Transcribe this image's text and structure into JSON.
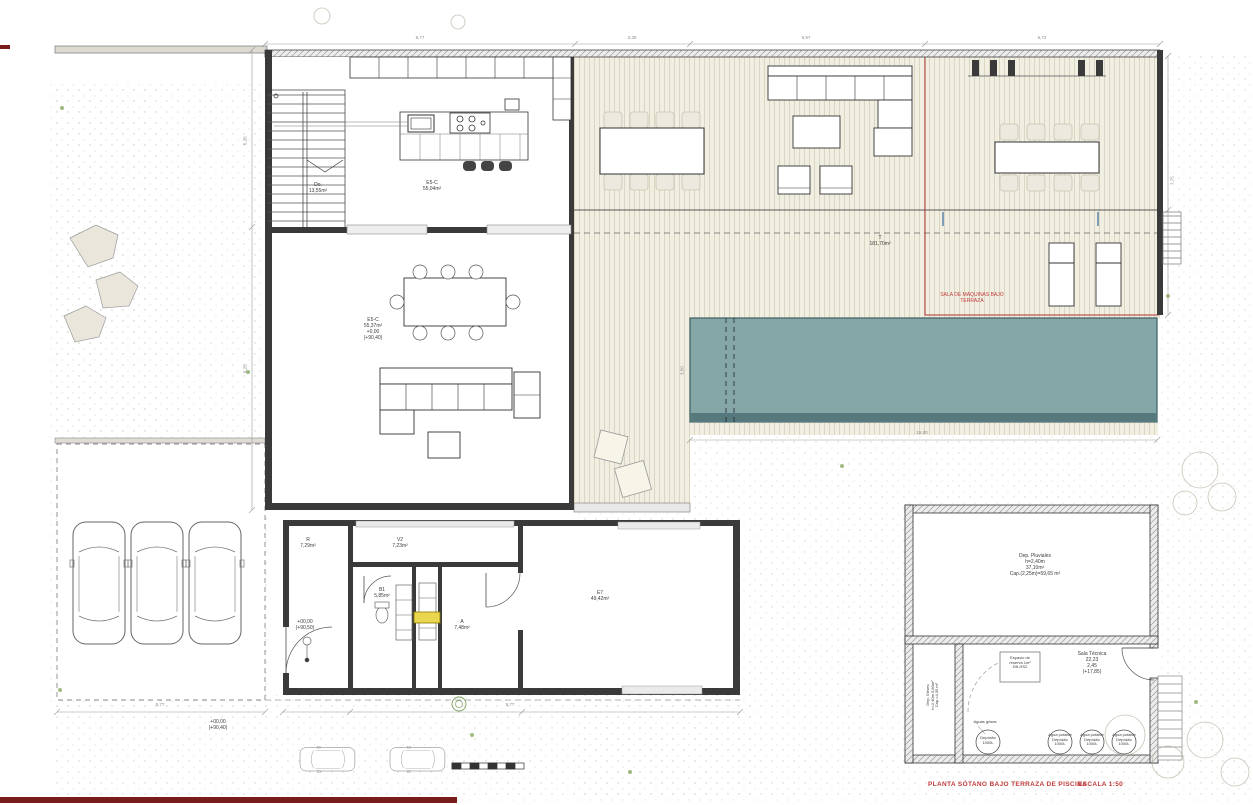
{
  "drawing": {
    "title": "PLANTA SÓTANO BAJO TERRAZA DE PISCINA",
    "scale": "ESCALA 1:50"
  },
  "colors": {
    "pool": "#85a7a8",
    "pool_dark": "#55797c",
    "deck": "#f1eee2",
    "deck_line": "#dbd6c2",
    "wall": "#3a3a3a",
    "red_line": "#b03232",
    "dark_red": "#7a1c1c",
    "annotation_red": "#c23b3b",
    "dim_grey": "#8a8a8a",
    "terrain_dot": "#b9b0a0",
    "boiler_yellow": "#ead64f",
    "green": "#8fae6b"
  },
  "annotations": [
    {
      "name": "stair-room-label",
      "text": "Do.\n13,55m²",
      "x": 318,
      "y": 183,
      "size": 5
    },
    {
      "name": "kitchen-label",
      "text": "E5-C\n55,04m²",
      "x": 432,
      "y": 181,
      "size": 5
    },
    {
      "name": "living-label",
      "text": "E5-C\n55,37m²\n+0,00\n(+90,40)",
      "x": 373,
      "y": 318,
      "size": 5
    },
    {
      "name": "terrace-label",
      "text": "T\n181,70m²",
      "x": 880,
      "y": 236,
      "size": 5
    },
    {
      "name": "machine-room-label",
      "text": "SALA DE MAQUINAS BAJO\nTERRAZA",
      "x": 972,
      "y": 293,
      "size": 5,
      "color": "#c23b3b"
    },
    {
      "name": "room-r-label",
      "text": "R\n7,29m²",
      "x": 308,
      "y": 538,
      "size": 5
    },
    {
      "name": "room-v2-label",
      "text": "V2\n7,23m²",
      "x": 400,
      "y": 538,
      "size": 5
    },
    {
      "name": "room-b1-label",
      "text": "B1\n5,85m²",
      "x": 382,
      "y": 588,
      "size": 5
    },
    {
      "name": "room-a-label",
      "text": "A\n7,48m²",
      "x": 462,
      "y": 620,
      "size": 5
    },
    {
      "name": "room-e7-label",
      "text": "E7\n49,42m²",
      "x": 600,
      "y": 591,
      "size": 5
    },
    {
      "name": "wing-level-label",
      "text": "+00,00\n(+90,50)",
      "x": 305,
      "y": 620,
      "size": 5
    },
    {
      "name": "carport-level-label",
      "text": "+00,00\n(+90,40)",
      "x": 218,
      "y": 720,
      "size": 5
    },
    {
      "name": "dep-pluviales-label",
      "text": "Dep. Pluviales\nh=2,40m\n37,10m²\nCap.(2,25m)=59,65 m³",
      "x": 1035,
      "y": 554,
      "size": 5
    },
    {
      "name": "dep-grises-label",
      "text": "Dep. Grises\nh=2,40m  5,80m²\nCap.=4,35 m³",
      "x": 933,
      "y": 688,
      "size": 4,
      "rotate": -90
    },
    {
      "name": "espacio-reserva-label",
      "text": "Espacio de\nreserva 1m²\nDB-HS2",
      "x": 1020,
      "y": 656,
      "size": 4
    },
    {
      "name": "sala-tecnica-label",
      "text": "Sala Técnica\n22,23\n2,45\n(+17,85)",
      "x": 1092,
      "y": 652,
      "size": 5
    },
    {
      "name": "aguas-grises-label",
      "text": "Aguas grises",
      "x": 985,
      "y": 720,
      "size": 4
    },
    {
      "name": "deposito-label",
      "text": "Depósito\n1000L",
      "x": 988,
      "y": 736,
      "size": 4
    },
    {
      "name": "agua-potable-1-label",
      "text": "Agua potable\nDepósito\n1000L",
      "x": 1060,
      "y": 733,
      "size": 4
    },
    {
      "name": "agua-potable-2-label",
      "text": "Agua potable\nDepósito\n1000L",
      "x": 1092,
      "y": 733,
      "size": 4
    },
    {
      "name": "agua-potable-3-label",
      "text": "Agua potable\nDepósito\n1000L",
      "x": 1124,
      "y": 733,
      "size": 4
    },
    {
      "name": "dim-top-1",
      "text": "8,77",
      "x": 420,
      "y": 35,
      "size": 4.5,
      "color": "#8a8a8a"
    },
    {
      "name": "dim-top-2",
      "text": "3,30",
      "x": 632,
      "y": 35,
      "size": 4.5,
      "color": "#8a8a8a"
    },
    {
      "name": "dim-top-3",
      "text": "6,97",
      "x": 806,
      "y": 35,
      "size": 4.5,
      "color": "#8a8a8a"
    },
    {
      "name": "dim-top-4",
      "text": "6,72",
      "x": 1042,
      "y": 35,
      "size": 4.5,
      "color": "#8a8a8a"
    },
    {
      "name": "dim-left-1",
      "text": "5,35",
      "x": 245,
      "y": 138,
      "size": 4.5,
      "color": "#8a8a8a",
      "rotate": -90
    },
    {
      "name": "dim-left-2",
      "text": "8,25",
      "x": 245,
      "y": 366,
      "size": 4.5,
      "color": "#8a8a8a",
      "rotate": -90
    },
    {
      "name": "dim-right-1",
      "text": "7,75",
      "x": 1172,
      "y": 178,
      "size": 4.5,
      "color": "#8a8a8a",
      "rotate": -90
    },
    {
      "name": "dim-pool-width",
      "text": "15,00",
      "x": 922,
      "y": 430,
      "size": 4.5,
      "color": "#8a8a8a"
    },
    {
      "name": "dim-pool-height",
      "text": "3,50",
      "x": 682,
      "y": 368,
      "size": 4.5,
      "color": "#8a8a8a",
      "rotate": -90
    },
    {
      "name": "dim-wing-bottom",
      "text": "8,77",
      "x": 510,
      "y": 702,
      "size": 4.5,
      "color": "#8a8a8a"
    },
    {
      "name": "dim-carport-bottom",
      "text": "5,77",
      "x": 160,
      "y": 702,
      "size": 4.5,
      "color": "#8a8a8a"
    }
  ]
}
